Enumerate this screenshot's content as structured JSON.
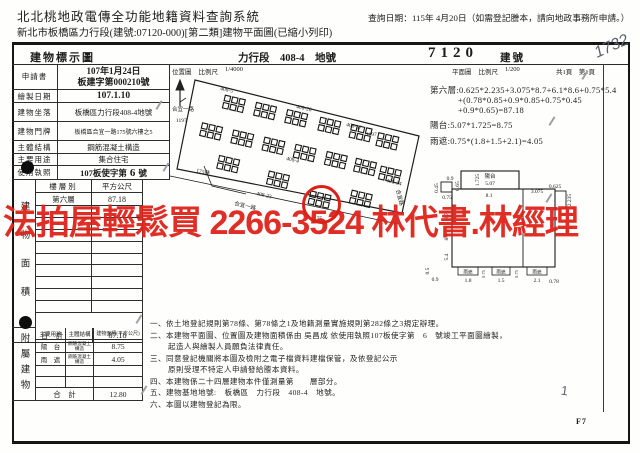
{
  "header": {
    "system_title": "北北桃地政電傳全功能地籍資料查詢系統",
    "query_date": "查詢日期：115年 4月20日（如需登記謄本，請向地政事務所申請。）",
    "subtitle": "新北市板橋區力行段(建號:07120-000)[第二類]建物平面圖(已縮小列印)"
  },
  "title_row": {
    "doc_title": "建物標示圖",
    "section_land": "力行段　408-4　地號",
    "building_number": "7120",
    "building_number_label": "建號"
  },
  "info_table": {
    "rows": [
      {
        "label": "申請書",
        "value": "107年1月24日",
        "value2": "板建字第000210號"
      },
      {
        "label": "繪製日期",
        "value": "107.1.10"
      },
      {
        "label": "建物坐落",
        "value": "板橋區力行段408-4地號"
      },
      {
        "label": "建物門牌",
        "value": "板橋區合宜一路175號六樓之5"
      },
      {
        "label": "主體結構",
        "value": "鋼筋混凝土構造"
      },
      {
        "label": "主要用途",
        "value": "集合住宅"
      }
    ],
    "license": {
      "label": "使用執照",
      "prefix": "107板使字第",
      "number": "6",
      "suffix": "號"
    }
  },
  "area_table": {
    "side_label": "建物面積",
    "col_floor": "樓層別",
    "col_area": "平方公尺",
    "floor": "第六層",
    "floor_area": "87.18",
    "total_label": "合　計",
    "total": "87.18"
  },
  "annex_table": {
    "side_label": "附屬建物",
    "col_use": "主要用途",
    "col_structure": "主體結構",
    "col_area": "建物面積(平方公尺)",
    "rows": [
      {
        "use": "陽　台",
        "structure": "鋼筋混凝土構造",
        "area": "8.75"
      },
      {
        "use": "雨　遮",
        "structure": "鋼筋混凝土構造",
        "area": "4.05"
      }
    ],
    "total_label": "合　計",
    "total": "12.80"
  },
  "location_map": {
    "title": "位置圖",
    "scale_label": "比例尺",
    "scale": "1/4000",
    "labels": {
      "lot_408_5": "408-5",
      "lot_408_26": "408-26",
      "lot_408_37": "408-37",
      "lot_1197_a": "1197",
      "lot_1197_b": "1197",
      "road_left": "合宜一路",
      "lane_175": "175巷",
      "lot_408_4": "408-4",
      "lot_408_23": "408-23",
      "road_bottom": "合宜一路",
      "lot_175_b": "175",
      "lot_408_34": "408-34",
      "road_right": "合宜路"
    }
  },
  "floor_plan": {
    "title": "平面圖",
    "scale_label": "比例尺",
    "scale": "1/200",
    "pages": "共1頁　第1頁",
    "calc_lines": [
      "第六層:0.625*2.235+3.075*8.7+6.1*8.6+0.75*5.4",
      "+(0.78*0.85+0.9*0.85+0.75*0.45",
      "+0.9*0.65)=87.18",
      "陽台:5.07*1.725=8.75",
      "雨遮:0.75*(1.8+1.5+2.1)=4.05"
    ],
    "dims": {
      "balcony": "陽台",
      "balcony_w": "5.07",
      "balcony_d": "1.725",
      "jog_top": "0.9",
      "jog_right": "0.65",
      "jog_left": "0.45",
      "jog_bottom": "0.75",
      "main_top": "8.1",
      "right_a": "3.075",
      "right_b": "0.625",
      "right_c": "2.235",
      "left_a": "8.7",
      "left_b": "8.6",
      "left_c": "5.4",
      "bl_a": "0.5",
      "bl_b": "0.9",
      "canopy": "雨遮",
      "canopy_w1": "1.8",
      "canopy_gap1": "0.75",
      "canopy_w2": "1.5",
      "canopy_gap2": "0.75",
      "canopy_w3": "2.1",
      "canopy_end": "0.78"
    }
  },
  "notes": {
    "lines": [
      "一、依土地登記規則第78條、第78條之1及地籍測量實施規則第282條之3規定辦理。",
      "二、本建物平面圖、位置圖及建物面積係由 吳昌成 依使用執照107板使字第　6　號竣工平面圖繪製，",
      "起造人與繪製人員願負法律責任。",
      "三、同意登記機關將本圖及檢附之電子檔資料建檔保管，及依登記公示",
      "原則受理不特定人申請發給謄本資料。",
      "四、本建物係二十四層建物本件僅測量第　　層部分。",
      "五、建物基地地號:　板橋區　力行段　408-4　地號。",
      "六、本圖以建物登記為限。"
    ]
  },
  "stamp": {
    "text": "法拍屋輕鬆買 2266-3524 林代書.林經理"
  },
  "annotations": {
    "handwritten_number": "1732",
    "page_code": "F7",
    "margin_mark": "1"
  }
}
